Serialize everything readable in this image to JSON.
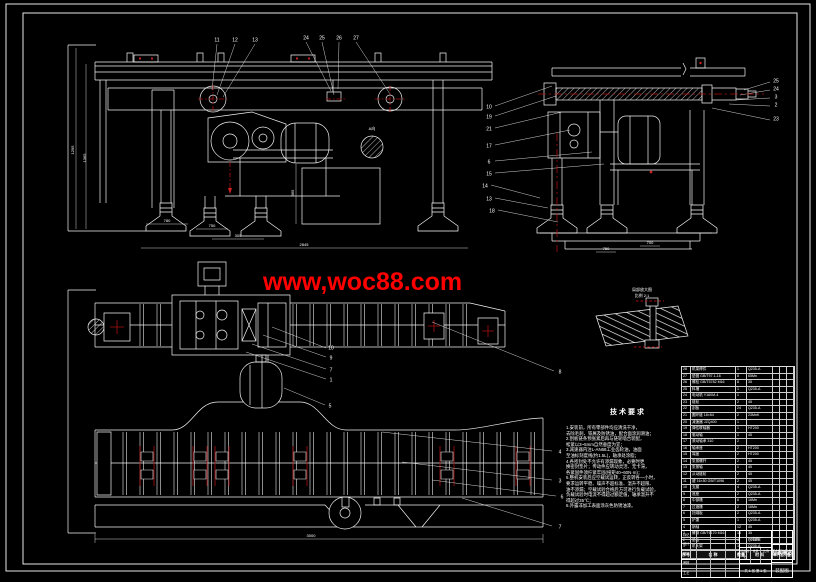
{
  "watermark": {
    "text": "www,woc88.com",
    "color": "#ff0000"
  },
  "colors": {
    "background": "#000000",
    "line": "#ffffff",
    "centerline_red": "#aa1111",
    "watermark_red": "#ff0000"
  },
  "views": {
    "front": {
      "callouts": [
        "11",
        "12",
        "13",
        "24",
        "25",
        "26",
        "27"
      ],
      "dims": [
        "1295",
        "1365",
        "780",
        "750",
        "305",
        "2845",
        "365"
      ],
      "section_tag": "A向"
    },
    "side": {
      "callouts": [
        "10",
        "19",
        "21",
        "17",
        "6",
        "15",
        "14",
        "13",
        "18",
        "25",
        "24",
        "3",
        "2",
        "23"
      ],
      "dims": [
        "750",
        "700"
      ]
    },
    "plan": {
      "callouts": [
        "10",
        "9",
        "7",
        "1",
        "5",
        "8",
        "4",
        "3",
        "6",
        "7"
      ],
      "dims": [
        "3000"
      ]
    },
    "detail": {
      "labels": [
        "局部放大图",
        "比例 2:1"
      ]
    }
  },
  "notes": {
    "title": "技术要求",
    "lines": [
      "1.安装前，所有零部件均应清洗干净，",
      "去除毛刺、铁屑及防锈油，配合面涂润滑油；",
      "2.刮板链条预张紧后再与链轮啮合装配，",
      "松紧以3~5mm自然垂度为宜；",
      "3.减速器内注L-AN68工业齿轮油，油面",
      "至油标刻度线(约1.5L)，轴承处涂脂；",
      "4.各密封处不允许有渗漏现象，必要时更",
      "换密封垫片；传动件应转动灵活、无卡滞，",
      "各紧固件须拧紧牢固(扭矩40~60N·m)；",
      "5.整机安装后应空载试运转，正反转各一小时，",
      "要求运转平稳、噪声不超标准、温升不超限、",
      "油不渗漏；空载试验合格后方可进行负载试验，",
      "负载试验时电流不得超过额定值，轴承温升不",
      "得超过35℃；",
      "6.外露非加工表面涂灰色防锈油漆。"
    ]
  },
  "bom": {
    "headers": [
      "序号",
      "名  称",
      "数量",
      "材  料",
      "单件",
      "总计",
      "备注"
    ],
    "rows": [
      [
        "28",
        "机架焊件",
        "1",
        "Q235-A",
        "",
        "",
        ""
      ],
      [
        "27",
        "垫圈 GB/T97.1-16",
        "8",
        "65Mn",
        "",
        "",
        ""
      ],
      [
        "26",
        "螺栓 GB/T5782 M16",
        "8",
        "35",
        "",
        "",
        ""
      ],
      [
        "25",
        "料槽",
        "1",
        "Q235-A",
        "",
        "",
        ""
      ],
      [
        "24",
        "电动机 Y160M-4",
        "1",
        "",
        "",
        "",
        ""
      ],
      [
        "23",
        "链轮",
        "2",
        "45",
        "",
        "",
        ""
      ],
      [
        "22",
        "刮板",
        "24",
        "Q235-A",
        "",
        "",
        ""
      ],
      [
        "21",
        "圆环链 18×64",
        "2",
        "23MnK",
        "",
        "",
        ""
      ],
      [
        "20",
        "减速器 JZQ400",
        "1",
        "",
        "",
        "",
        ""
      ],
      [
        "19",
        "弹性联轴器",
        "1",
        "HT200",
        "",
        "",
        ""
      ],
      [
        "18",
        "驱动轴",
        "1",
        "45",
        "",
        "",
        ""
      ],
      [
        "17",
        "滚动轴承 310",
        "2",
        "",
        "",
        "",
        ""
      ],
      [
        "16",
        "轴承座",
        "2",
        "HT200",
        "",
        "",
        ""
      ],
      [
        "15",
        "端盖",
        "2",
        "HT200",
        "",
        "",
        ""
      ],
      [
        "14",
        "张紧螺杆",
        "2",
        "45",
        "",
        "",
        ""
      ],
      [
        "13",
        "张紧轴",
        "1",
        "45",
        "",
        "",
        ""
      ],
      [
        "12",
        "从动链轮",
        "2",
        "45",
        "",
        "",
        ""
      ],
      [
        "11",
        "键 16×50 GB/T1096",
        "2",
        "45",
        "",
        "",
        ""
      ],
      [
        "10",
        "支腿",
        "4",
        "Q235-A",
        "",
        "",
        ""
      ],
      [
        "9",
        "底座",
        "2",
        "Q235-A",
        "",
        "",
        ""
      ],
      [
        "8",
        "中部槽",
        "6",
        "16Mn",
        "",
        "",
        ""
      ],
      [
        "7",
        "过渡槽",
        "2",
        "16Mn",
        "",
        "",
        ""
      ],
      [
        "6",
        "挡煤板",
        "2",
        "Q235-A",
        "",
        "",
        ""
      ],
      [
        "5",
        "护罩",
        "1",
        "Q235-A",
        "",
        "",
        ""
      ],
      [
        "4",
        "销轴",
        "12",
        "45",
        "",
        "",
        ""
      ],
      [
        "3",
        "螺母 GB/T6170 M16",
        "16",
        "35",
        "",
        "",
        ""
      ],
      [
        "2",
        "垫板",
        "4",
        "Q235-A",
        "",
        "",
        ""
      ],
      [
        "1",
        "机头架",
        "1",
        "Q235-A",
        "",
        "",
        ""
      ]
    ]
  },
  "titleblock": {
    "org": "××机械厂",
    "cols": [
      "阶段标记",
      "重量",
      "比例"
    ],
    "sheet": "共 1 张 第 1 张",
    "signs": [
      "标记",
      "设计",
      "校核",
      "审核",
      "工艺"
    ],
    "title": "刮板输送机",
    "subtitle": "装配图"
  }
}
